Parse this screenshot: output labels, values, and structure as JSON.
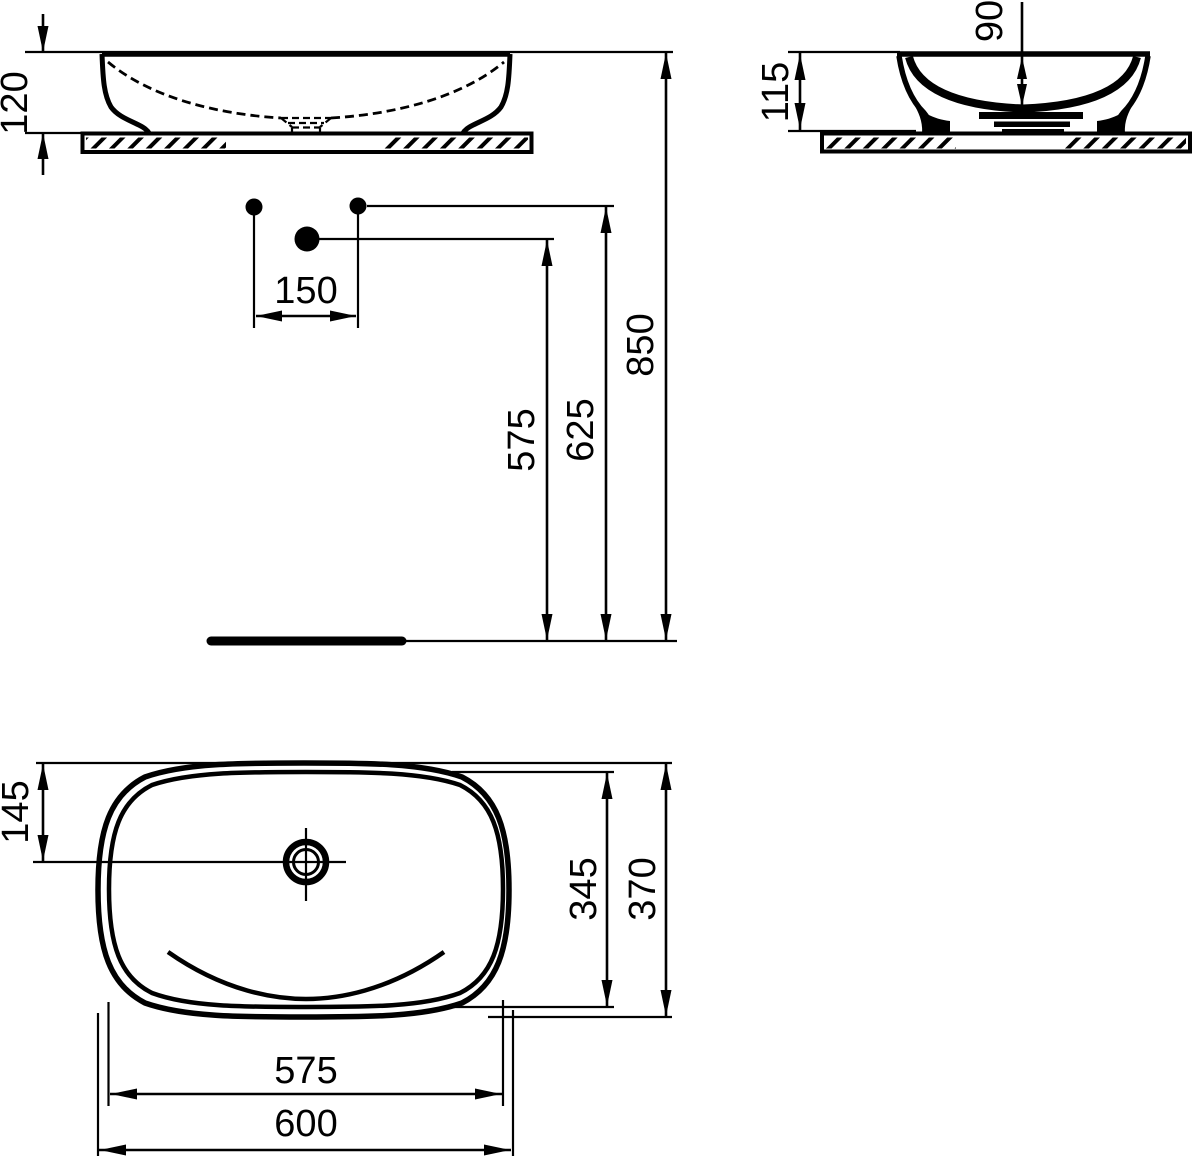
{
  "drawing": {
    "background": "#ffffff",
    "line_color": "#000000",
    "views": {
      "front": {
        "height_above_counter": "120"
      },
      "side": {
        "basin_height": "115",
        "bowl_depth": "90"
      },
      "installation": {
        "hole_spacing": "150",
        "waste_outlet_height": "575",
        "supply_height": "625",
        "rim_height": "850"
      },
      "top": {
        "drain_offset_from_edge": "145",
        "inner_depth": "345",
        "outer_depth": "370",
        "inner_width": "575",
        "outer_width": "600"
      }
    }
  }
}
